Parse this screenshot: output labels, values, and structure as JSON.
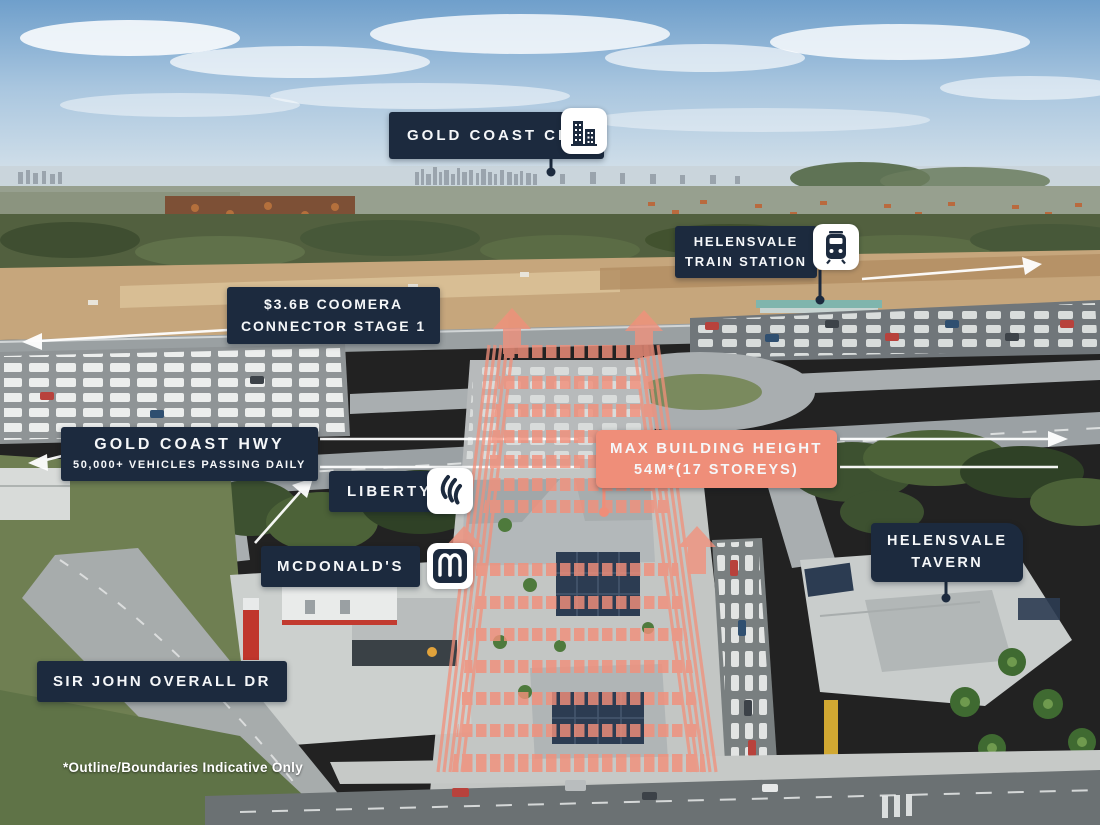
{
  "colors": {
    "label_bg": "#1C2A3E",
    "accent_salmon": "#EF8E79",
    "overlay_salmon": "#F2907B",
    "label_text": "#FFFFFF"
  },
  "annotations": {
    "gold_coast_cbd": {
      "label": "GOLD COAST CBD",
      "icon": "city-buildings-icon"
    },
    "helensvale_train_station": {
      "line1": "HELENSVALE",
      "line2": "TRAIN STATION",
      "icon": "train-icon"
    },
    "coomera_connector": {
      "line1": "$3.6B COOMERA",
      "line2": "CONNECTOR STAGE 1"
    },
    "gold_coast_hwy": {
      "line1": "GOLD COAST HWY",
      "line2": "50,000+ VEHICLES PASSING DAILY"
    },
    "liberty": {
      "label": "LIBERTY",
      "icon": "liberty-flame-icon"
    },
    "mcdonalds": {
      "label": "MCDONALD'S",
      "icon": "mcdonalds-arches-icon"
    },
    "max_building_height": {
      "line1": "MAX BUILDING HEIGHT",
      "line2": "54M*(17 STOREYS)"
    },
    "helensvale_tavern": {
      "line1": "HELENSVALE",
      "line2": "TAVERN"
    },
    "sir_john_overall_dr": {
      "label": "SIR JOHN OVERALL DR"
    },
    "disclaimer": {
      "label": "*Outline/Boundaries Indicative Only"
    }
  }
}
